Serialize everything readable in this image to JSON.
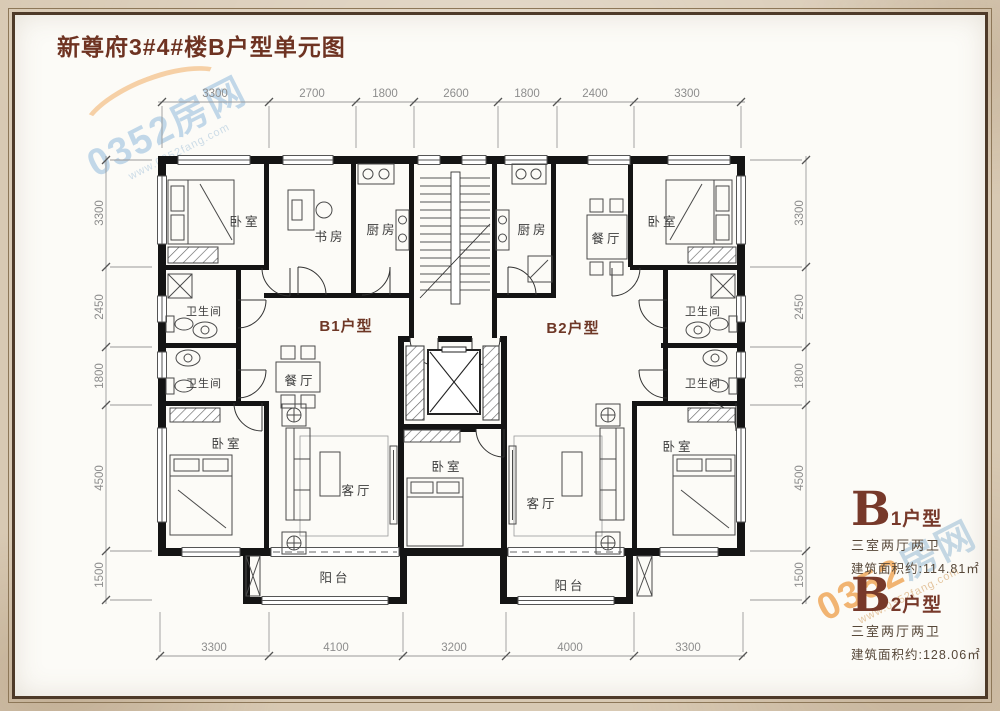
{
  "title": "新尊府3#4#楼B户型单元图",
  "watermark": {
    "brand_num": "0352",
    "brand_cn": "房网",
    "url": "www.0352fang.com"
  },
  "plan": {
    "unit_b1": "B1户型",
    "unit_b2": "B2户型",
    "rooms": {
      "bedroom": "卧室",
      "study": "书房",
      "kitchen": "厨房",
      "bathroom": "卫生间",
      "dining": "餐厅",
      "living": "客厅",
      "balcony": "阳台"
    }
  },
  "dimensions": {
    "top": [
      "3300",
      "2700",
      "1800",
      "2600",
      "1800",
      "2400",
      "3300"
    ],
    "bottom": [
      "3300",
      "4100",
      "3200",
      "4000",
      "3300"
    ],
    "left": [
      "3300",
      "2450",
      "1800",
      "4500",
      "1500"
    ],
    "right": [
      "3300",
      "2450",
      "1800",
      "4500",
      "1500"
    ]
  },
  "info": {
    "b1": {
      "letter": "B",
      "suffix": "1户型",
      "layout": "三室两厅两卫",
      "area": "建筑面积约:114.81㎡"
    },
    "b2": {
      "letter": "B",
      "suffix": "2户型",
      "layout": "三室两厅两卫",
      "area": "建筑面积约:128.06㎡"
    }
  },
  "colors": {
    "accent": "#6e3322",
    "paper": "#d8c9b3",
    "wall": "#141414",
    "dim_text": "#8d8d8d"
  }
}
